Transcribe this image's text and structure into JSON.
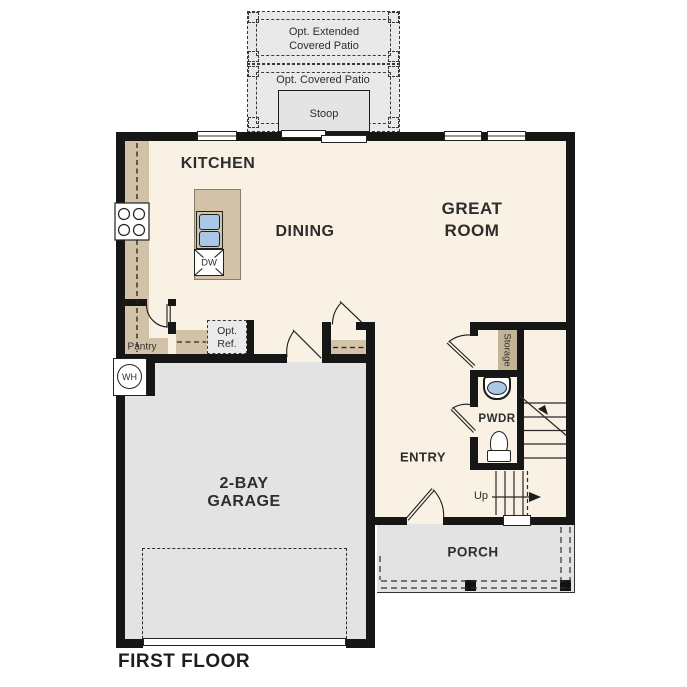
{
  "title": "FIRST FLOOR",
  "rooms": {
    "kitchen": "KITCHEN",
    "dining": "DINING",
    "great_room": [
      "GREAT",
      "ROOM"
    ],
    "garage": [
      "2-BAY",
      "GARAGE"
    ],
    "entry": "ENTRY",
    "porch": "PORCH",
    "pwdr": "PWDR",
    "pantry": "Pantry",
    "storage": "Storage"
  },
  "outdoor": {
    "ext_patio": [
      "Opt. Extended",
      "Covered Patio"
    ],
    "cov_patio": "Opt. Covered Patio",
    "stoop": "Stoop"
  },
  "fixtures": {
    "water_heater": "WH",
    "dishwasher": "DW",
    "opt_ref": [
      "Opt.",
      "Ref."
    ],
    "up": "Up"
  },
  "colors": {
    "floor": "#f8f1e4",
    "concrete": "#e6e6e6",
    "counter": "#d2c3a8",
    "sink_blue": "#a9c7e6",
    "wall": "#161616"
  }
}
